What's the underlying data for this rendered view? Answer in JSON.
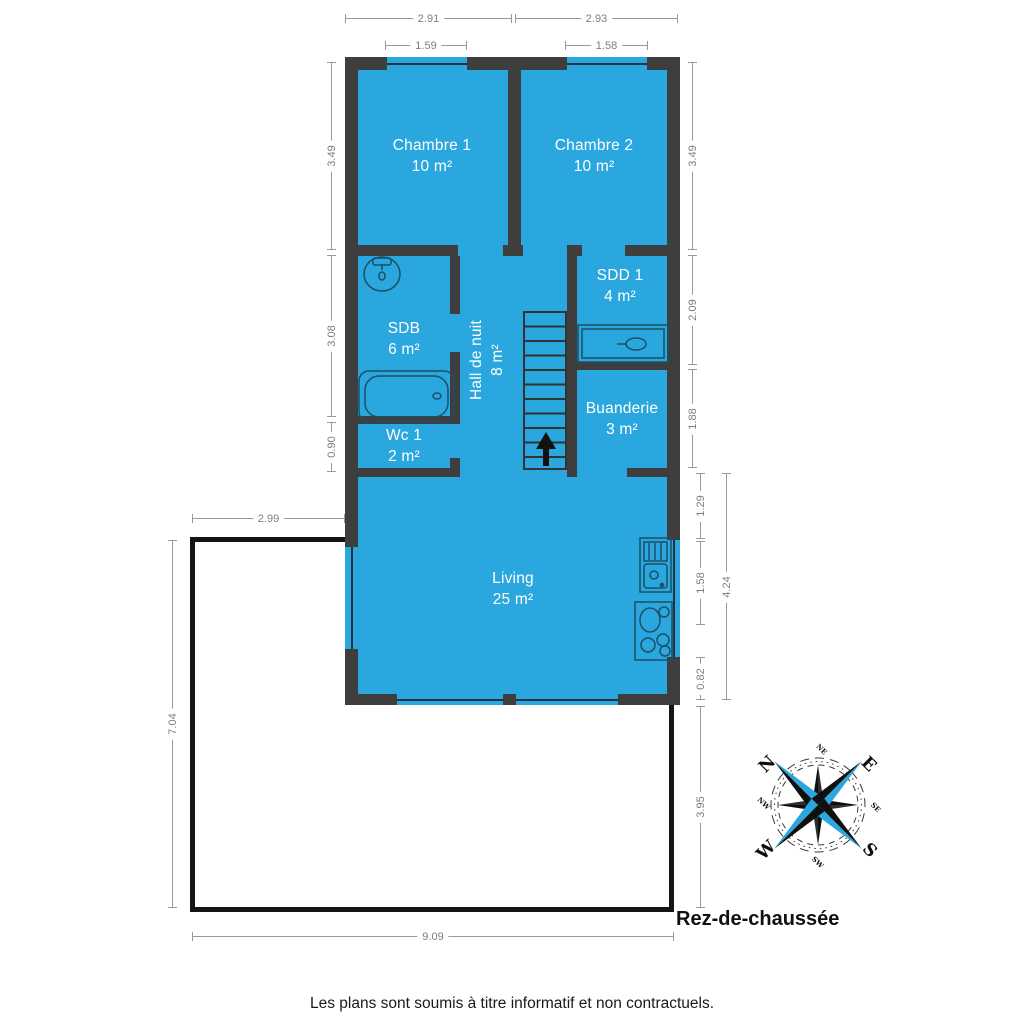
{
  "plan": {
    "floor_label": "Rez-de-chaussée",
    "disclaimer": "Les plans sont soumis à titre informatif et non contractuels."
  },
  "rooms": [
    {
      "name": "Chambre 1",
      "area": "10 m²"
    },
    {
      "name": "Chambre 2",
      "area": "10 m²"
    },
    {
      "name": "SDB",
      "area": "6 m²"
    },
    {
      "name": "Hall de nuit",
      "area": "8 m²"
    },
    {
      "name": "SDD 1",
      "area": "4 m²"
    },
    {
      "name": "Buanderie",
      "area": "3 m²"
    },
    {
      "name": "Wc 1",
      "area": "2 m²"
    },
    {
      "name": "Living",
      "area": "25 m²"
    }
  ],
  "dims": {
    "chambre1_width": "2.91",
    "chambre2_width": "2.93",
    "chambre1_window": "1.59",
    "chambre2_window": "1.58",
    "left_chambre1_depth": "3.49",
    "left_sdb": "3.08",
    "left_wc": "0.90",
    "right_chambre2_depth": "3.49",
    "right_sdd1": "2.09",
    "right_buanderie": "1.88",
    "right_living_upper": "1.29",
    "right_living_window": "1.58",
    "right_living_lower": "0.82",
    "right_living_total": "4.24",
    "right_terrace": "3.95",
    "terrace_width_top": "2.99",
    "terrace_height_left": "7.04",
    "terrace_width_bottom": "9.09"
  },
  "compass": {
    "n": "N",
    "e": "E",
    "s": "S",
    "w": "W",
    "ne": "NE",
    "se": "SE",
    "sw": "SW",
    "nw": "NW"
  },
  "colors": {
    "room_fill": "#2AA7DE",
    "wall": "#3E3E3E",
    "terrace_outline": "#151515",
    "compass_blue": "#2AA7DE",
    "dimension_line": "#9A9A9A"
  }
}
